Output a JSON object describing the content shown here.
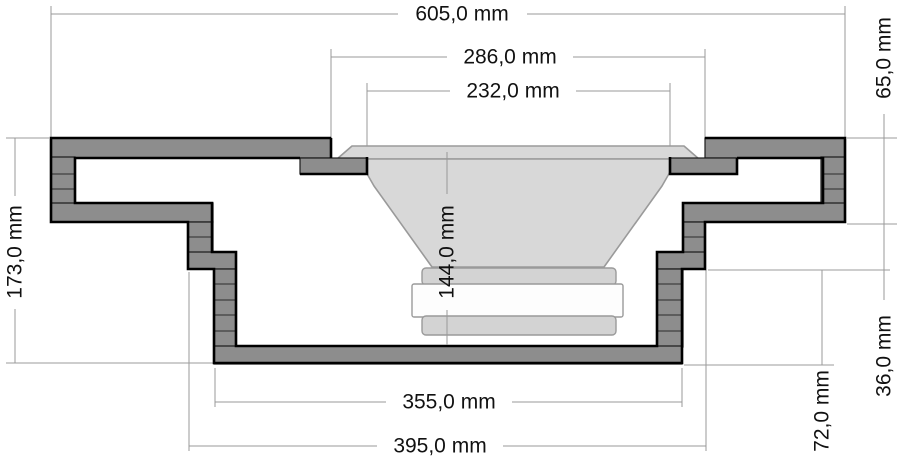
{
  "drawing": {
    "unit": "mm",
    "decimal_separator": ",",
    "dimensions": {
      "width_overall": {
        "label": "605,0 mm",
        "value": 605.0,
        "orientation": "horizontal"
      },
      "flange_recess_width": {
        "label": "286,0 mm",
        "value": 286.0,
        "orientation": "horizontal"
      },
      "cutout_width": {
        "label": "232,0 mm",
        "value": 232.0,
        "orientation": "horizontal"
      },
      "bottom_box_width": {
        "label": "355,0 mm",
        "value": 355.0,
        "orientation": "horizontal"
      },
      "middle_step_width": {
        "label": "395,0 mm",
        "value": 395.0,
        "orientation": "horizontal"
      },
      "height_overall": {
        "label": "173,0 mm",
        "value": 173.0,
        "orientation": "vertical"
      },
      "mounting_depth": {
        "label": "144,0 mm",
        "value": 144.0,
        "orientation": "vertical"
      },
      "rim_height": {
        "label": "65,0 mm",
        "value": 65.0,
        "orientation": "vertical"
      },
      "middle_step_height": {
        "label": "36,0 mm",
        "value": 36.0,
        "orientation": "vertical"
      },
      "bottom_box_height": {
        "label": "72,0 mm",
        "value": 72.0,
        "orientation": "vertical"
      }
    },
    "colors": {
      "background": "#ffffff",
      "wood_fill": "#8d8d8d",
      "part_outline": "#000000",
      "dimension_line": "#999999",
      "speaker_body": "#d8d8d8",
      "magnet_plate": "#d3d3d3",
      "pole_plate": "#fdfdfd",
      "text": "#111111"
    }
  }
}
